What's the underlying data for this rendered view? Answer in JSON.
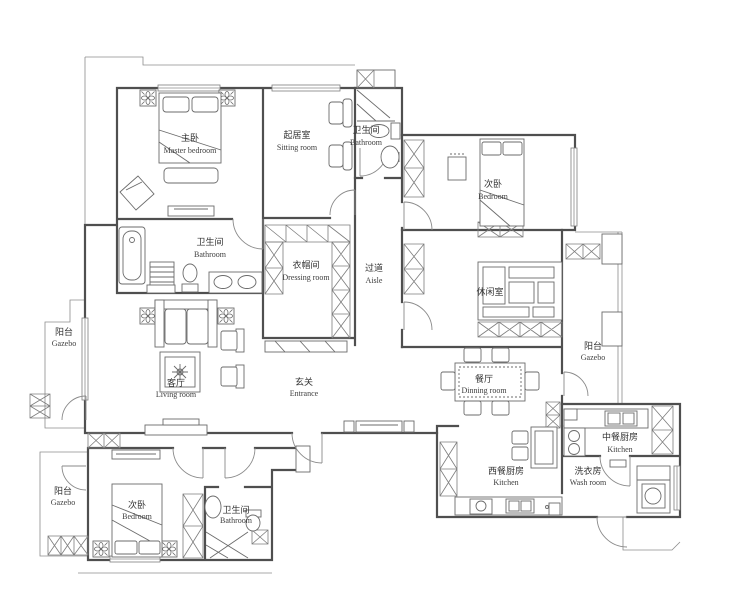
{
  "app": {
    "type": "residential floor plan drawing",
    "background_color": "#ffffff",
    "wall_color": "#4f4f4f",
    "furniture_line_color": "#6b6b6b",
    "text_color": "#333333"
  },
  "rooms": {
    "master_bedroom": {
      "cn": "主卧",
      "en": "Master bedroom"
    },
    "sitting_room": {
      "cn": "起居室",
      "en": "Sitting room"
    },
    "bathroom_top": {
      "cn": "卫生间",
      "en": "Bathroom"
    },
    "bedroom_right": {
      "cn": "次卧",
      "en": "Bedroom"
    },
    "bathroom_mid": {
      "cn": "卫生间",
      "en": "Bathroom"
    },
    "dressing_room": {
      "cn": "衣帽间",
      "en": "Dressing room"
    },
    "aisle": {
      "cn": "过道",
      "en": "Aisle"
    },
    "leisure_room": {
      "cn": "休闲室",
      "en": ""
    },
    "gazebo_left": {
      "cn": "阳台",
      "en": "Gazebo"
    },
    "living_room": {
      "cn": "客厅",
      "en": "Living room"
    },
    "entrance": {
      "cn": "玄关",
      "en": "Entrance"
    },
    "dining_room": {
      "cn": "餐厅",
      "en": "Dinning room"
    },
    "gazebo_right": {
      "cn": "阳台",
      "en": "Gazebo"
    },
    "kitchen_chinese": {
      "cn": "中餐厨房",
      "en": "Kitchen"
    },
    "kitchen_west": {
      "cn": "西餐厨房",
      "en": "Kitchen"
    },
    "wash_room": {
      "cn": "洗衣房",
      "en": "Wash room"
    },
    "gazebo_bottom": {
      "cn": "阳台",
      "en": "Gazebo"
    },
    "bedroom_bottom": {
      "cn": "次卧",
      "en": "Bedroom"
    },
    "bathroom_bottom": {
      "cn": "卫生间",
      "en": "Bathroom"
    }
  }
}
